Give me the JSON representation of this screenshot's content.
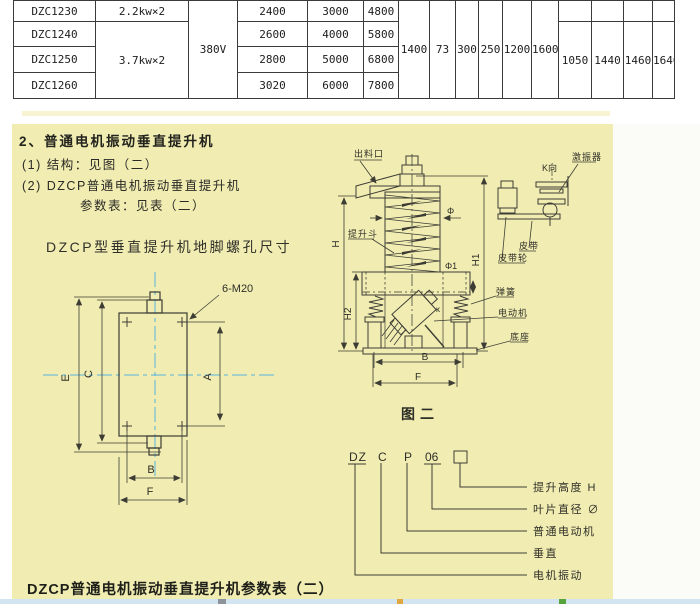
{
  "table": {
    "voltage": "380V",
    "rows": [
      {
        "model": "DZC1230",
        "power": "2.2kw×2",
        "v1": "2400",
        "v2": "3000",
        "v3": "4800"
      },
      {
        "model": "DZC1240",
        "power": "3.7kw×2",
        "v1": "2600",
        "v2": "4000",
        "v3": "5800"
      },
      {
        "model": "DZC1250",
        "v1": "2800",
        "v2": "5000",
        "v3": "6800"
      },
      {
        "model": "DZC1260",
        "v1": "3020",
        "v2": "6000",
        "v3": "7800"
      }
    ],
    "span_values": [
      "1400",
      "73",
      "300",
      "250",
      "1200",
      "1600"
    ],
    "span_values2": [
      "1050",
      "1440",
      "1460",
      "1640"
    ]
  },
  "section": {
    "heading": "2、普通电机振动垂直提升机",
    "item1": "(1) 结构：见图（二）",
    "item2": "(2) DZCP普通电机振动垂直提升机",
    "item2b": "参数表：见表（二）",
    "left_drawing_title": "DZCP型垂直提升机地脚螺孔尺寸",
    "bottom_title": "DZCP普通电机振动垂直提升机参数表（二）"
  },
  "figure2": {
    "caption": "图二",
    "outlet": "出料口",
    "bucket": "提升斗",
    "spring": "弹簧",
    "motor": "电动机",
    "base": "底座",
    "belt": "皮带",
    "pulley": "皮带轮",
    "vibrator": "激振器",
    "k_view": "K向",
    "kappa": "κ",
    "phi": "Φ",
    "phi1": "Φ1",
    "dim_h": "H",
    "dim_h1": "H1",
    "dim_h2": "H2",
    "dim_b": "B",
    "dim_f": "F"
  },
  "left_drawing": {
    "bolt_label": "6-M20",
    "dim_e": "E",
    "dim_c": "C",
    "dim_a": "A",
    "dim_b": "B",
    "dim_f": "F"
  },
  "model_code": {
    "p1": "DZ",
    "p2": "C",
    "p3": "P",
    "p4": "06",
    "legend1": "提升高度 H",
    "legend2": "叶片直径 ∅",
    "legend3": "普通电动机",
    "legend4": "垂直",
    "legend5": "电机振动"
  },
  "colors": {
    "panel_beige": "#f1edb2",
    "strip_blue": "#d3e5f1",
    "centerline_blue": "#58b4dd"
  }
}
